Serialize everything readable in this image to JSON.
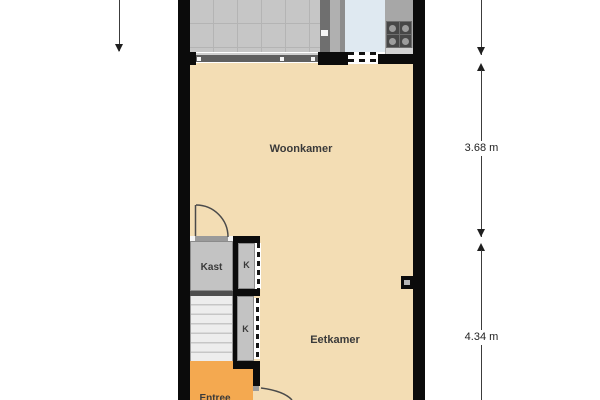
{
  "floorplan": {
    "rooms": {
      "woonkamer": {
        "label": "Woonkamer"
      },
      "eetkamer": {
        "label": "Eetkamer"
      },
      "kast": {
        "label": "Kast"
      },
      "closet_upper": {
        "label": "K"
      },
      "closet_lower": {
        "label": "K"
      },
      "entree": {
        "label": "Entree"
      }
    },
    "dimensions": {
      "upper": {
        "label": "3.68 m"
      },
      "lower": {
        "label": "4.34 m"
      }
    },
    "colors": {
      "wall": "#0b0b0b",
      "living_floor": "#f3ddb4",
      "entree_floor": "#f4a950",
      "closet_floor": "#c3c3c3",
      "stairs_floor": "#ededed",
      "balcony_floor": "#c6c6c6",
      "kitchen_floor": "#dfe9f1",
      "stove": "#3a3a3a",
      "counter": "#a7a7a7"
    }
  }
}
